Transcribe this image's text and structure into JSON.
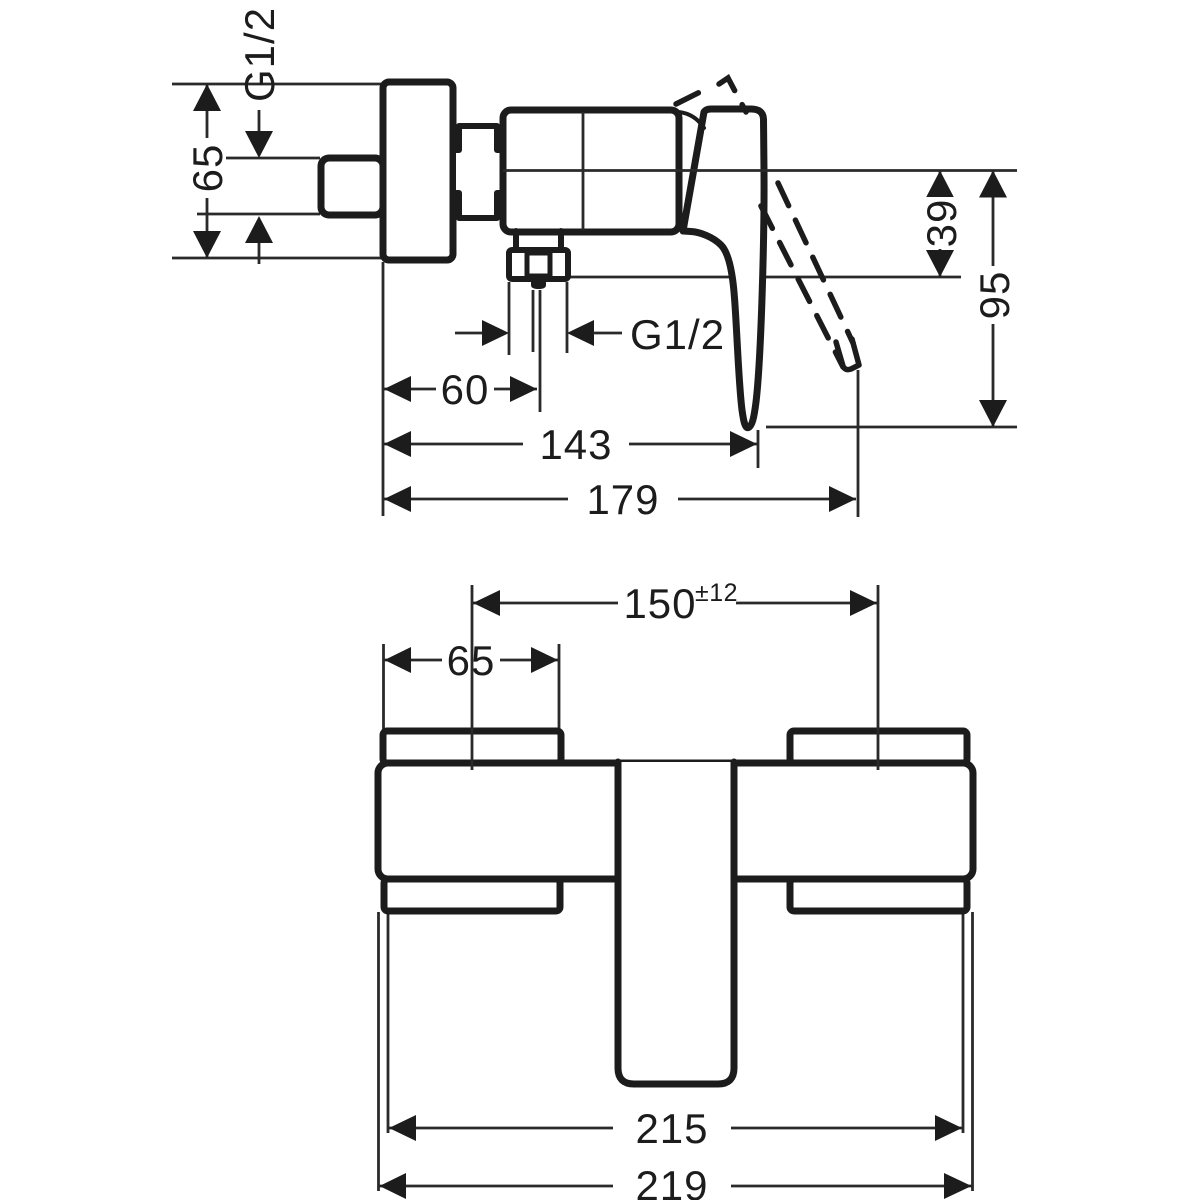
{
  "drawing": {
    "kind": "technical-dimension-drawing",
    "side_view": {
      "labels": {
        "inlet_thread": "G1/2",
        "outlet_thread": "G1/2"
      },
      "dimensions": {
        "escutcheon_height": "65",
        "center_to_outlet_drop": "39",
        "center_to_lever_tip": "95",
        "wall_to_outlet_center": "60",
        "wall_to_lever": "143",
        "overall_depth": "179"
      }
    },
    "top_view": {
      "dimensions": {
        "connection_centers": "150",
        "connection_centers_tolerance": "±12",
        "escutcheon_width": "65",
        "body_width": "215",
        "overall_width": "219"
      }
    }
  }
}
